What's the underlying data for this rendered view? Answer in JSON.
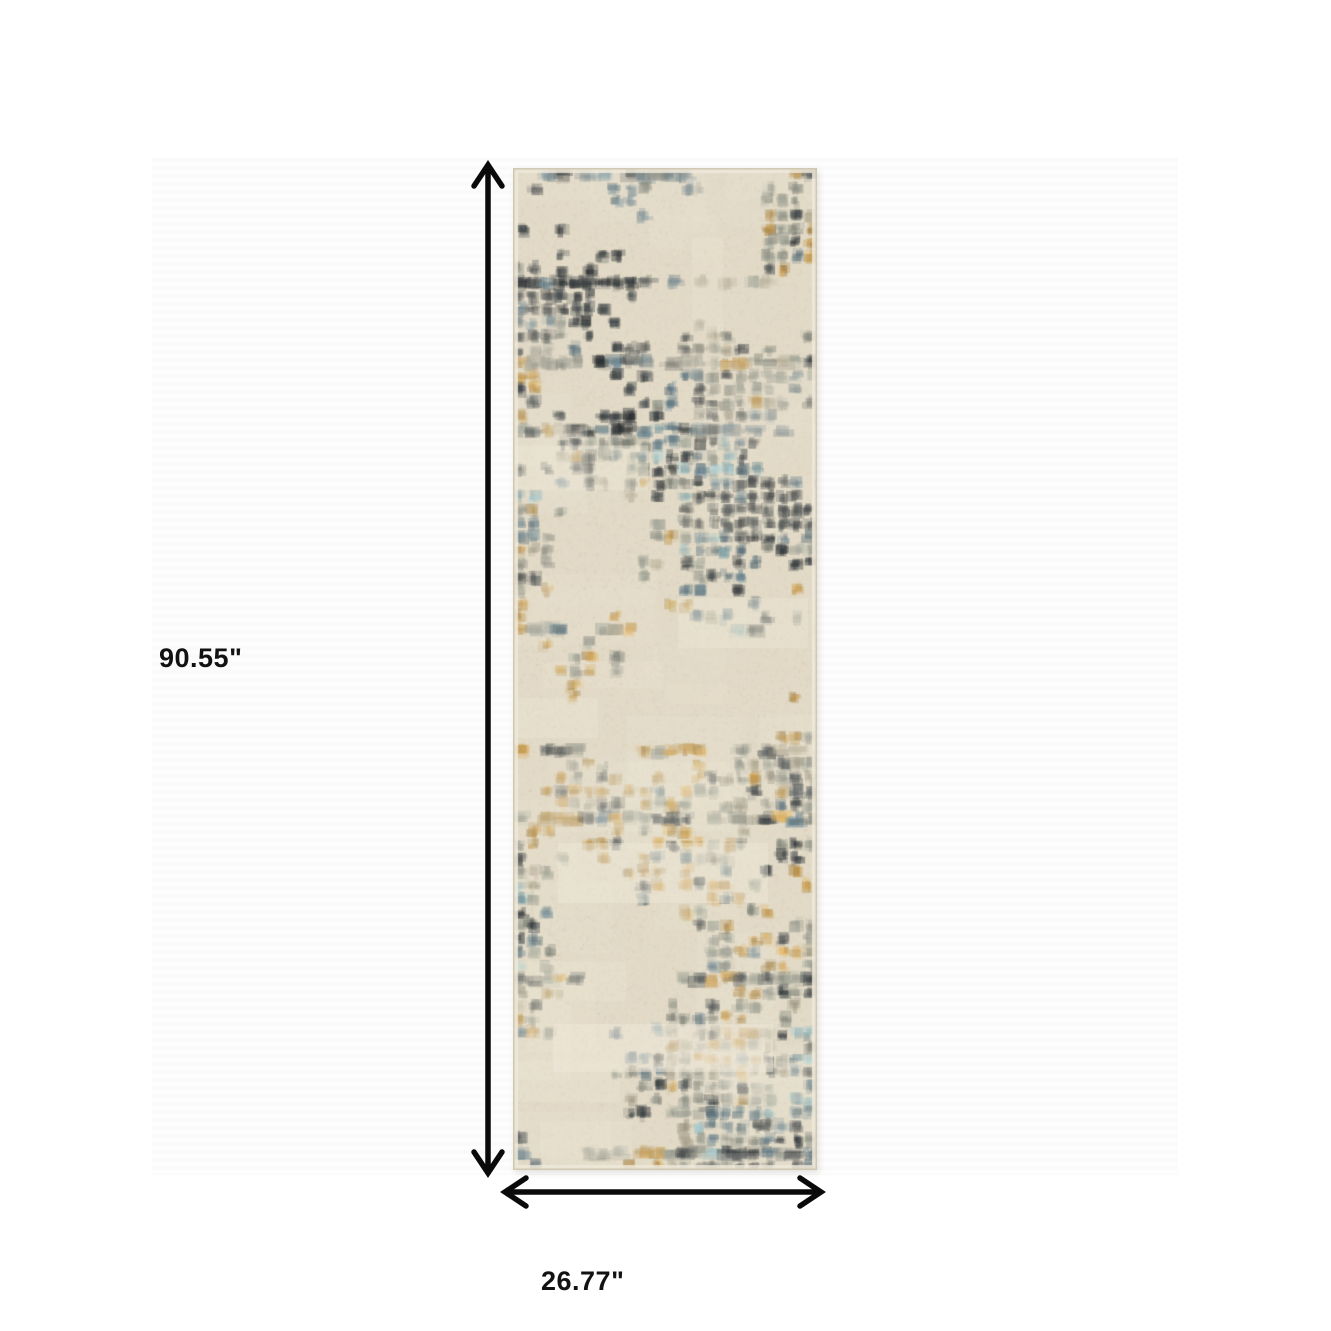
{
  "image": {
    "description": "Abstract distressed plaid runner rug shown with dimension arrows",
    "height_label": "90.55\"",
    "width_label": "26.77\"",
    "arrow_color": "#0a0a0a",
    "label_color": "#121212",
    "rug_palette": {
      "base": "#e2dac7",
      "base_light": "#eee8d8",
      "base_dark": "#c9bfa6",
      "edge": "#efe9da",
      "edge_outline": "#cfc6b0",
      "ink": "#23282c",
      "charcoal": "#353b3e",
      "slate": "#5d7580",
      "teal": "#8fb0b5",
      "gray": "#8e9186",
      "warmgray": "#a69f8a",
      "gold": "#b98f46",
      "amber": "#caa458"
    }
  }
}
